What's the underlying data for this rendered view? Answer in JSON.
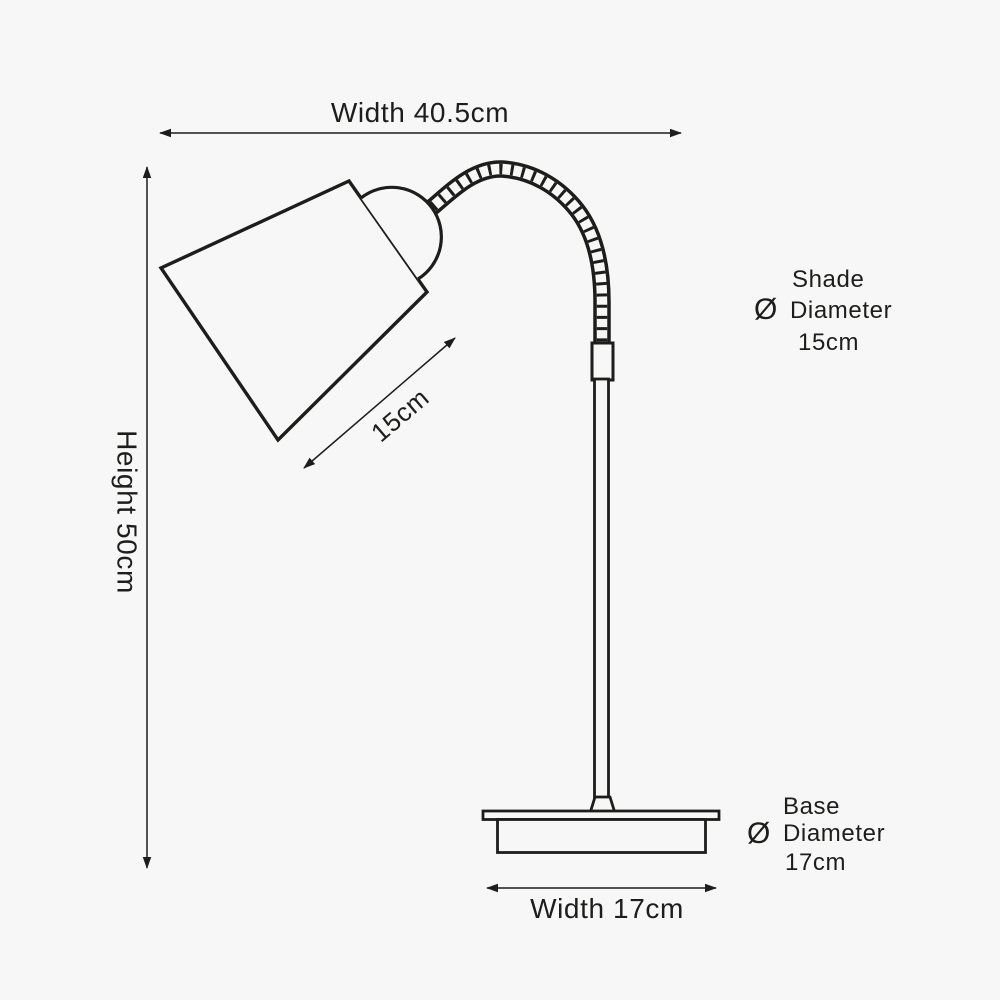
{
  "diagram": {
    "subject": "table lamp dimension drawing",
    "background_color": "#f7f7f7",
    "line_color": "#1d1d1b"
  },
  "dimension_labels": {
    "overall_width": "Width 40.5cm",
    "overall_height": "Height 50cm",
    "shade_width": "15cm",
    "base_width": "Width 17cm"
  },
  "callouts": {
    "shade": {
      "title": "Shade",
      "symbol": "Ø",
      "property": "Diameter",
      "value": "15cm"
    },
    "base": {
      "title": "Base",
      "symbol": "Ø",
      "property": "Diameter",
      "value": "17cm"
    }
  },
  "values_cm": {
    "overall_width": 40.5,
    "overall_height": 50,
    "shade_diameter": 15,
    "base_diameter": 17,
    "base_width": 17
  }
}
